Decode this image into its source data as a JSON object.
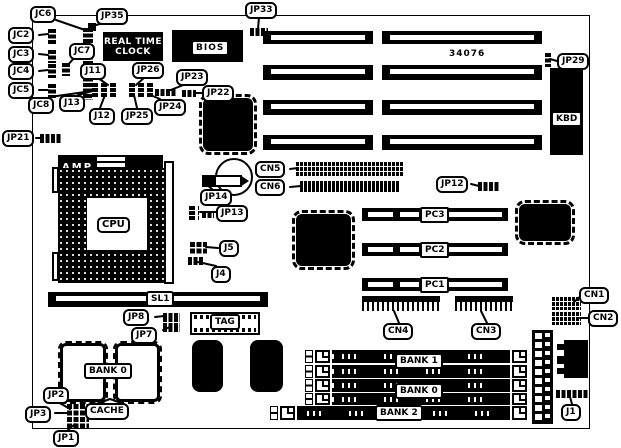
{
  "part_number": "34076",
  "colors": {
    "ink": "#000000",
    "paper": "#ffffff"
  },
  "labels": {
    "jc6": "JC6",
    "jc2": "JC2",
    "jc3": "JC3",
    "jc4": "JC4",
    "jc5": "JC5",
    "jc7": "JC7",
    "jc8": "JC8",
    "jp35": "JP35",
    "jp33": "JP33",
    "jp21": "JP21",
    "jp29": "JP29",
    "j11": "J11",
    "j12": "J12",
    "j13": "J13",
    "jp26": "JP26",
    "jp25": "JP25",
    "jp24": "JP24",
    "jp23": "JP23",
    "jp22": "JP22",
    "jp14": "JP14",
    "jp13": "JP13",
    "j5": "J5",
    "j4": "J4",
    "cn5": "CN5",
    "cn6": "CN6",
    "jp12": "JP12",
    "cn4": "CN4",
    "cn3": "CN3",
    "cn1": "CN1",
    "cn2": "CN2",
    "jp8": "JP8",
    "jp7": "JP7",
    "jp2": "JP2",
    "jp3": "JP3",
    "jp1": "JP1",
    "j1": "J1"
  },
  "components": {
    "rtc_line1": "REAL TIME",
    "rtc_line2": "CLOCK",
    "bios": "BIOS",
    "cpu": "CPU",
    "amp": "AMP",
    "kbd": "KBD",
    "sl1": "SL1",
    "tag": "TAG",
    "cache": "CACHE",
    "bank0_cache": "BANK 0",
    "bank1": "BANK 1",
    "bank0_simm": "BANK 0",
    "bank2": "BANK 2",
    "pc1": "PC1",
    "pc2": "PC2",
    "pc3": "PC3"
  }
}
